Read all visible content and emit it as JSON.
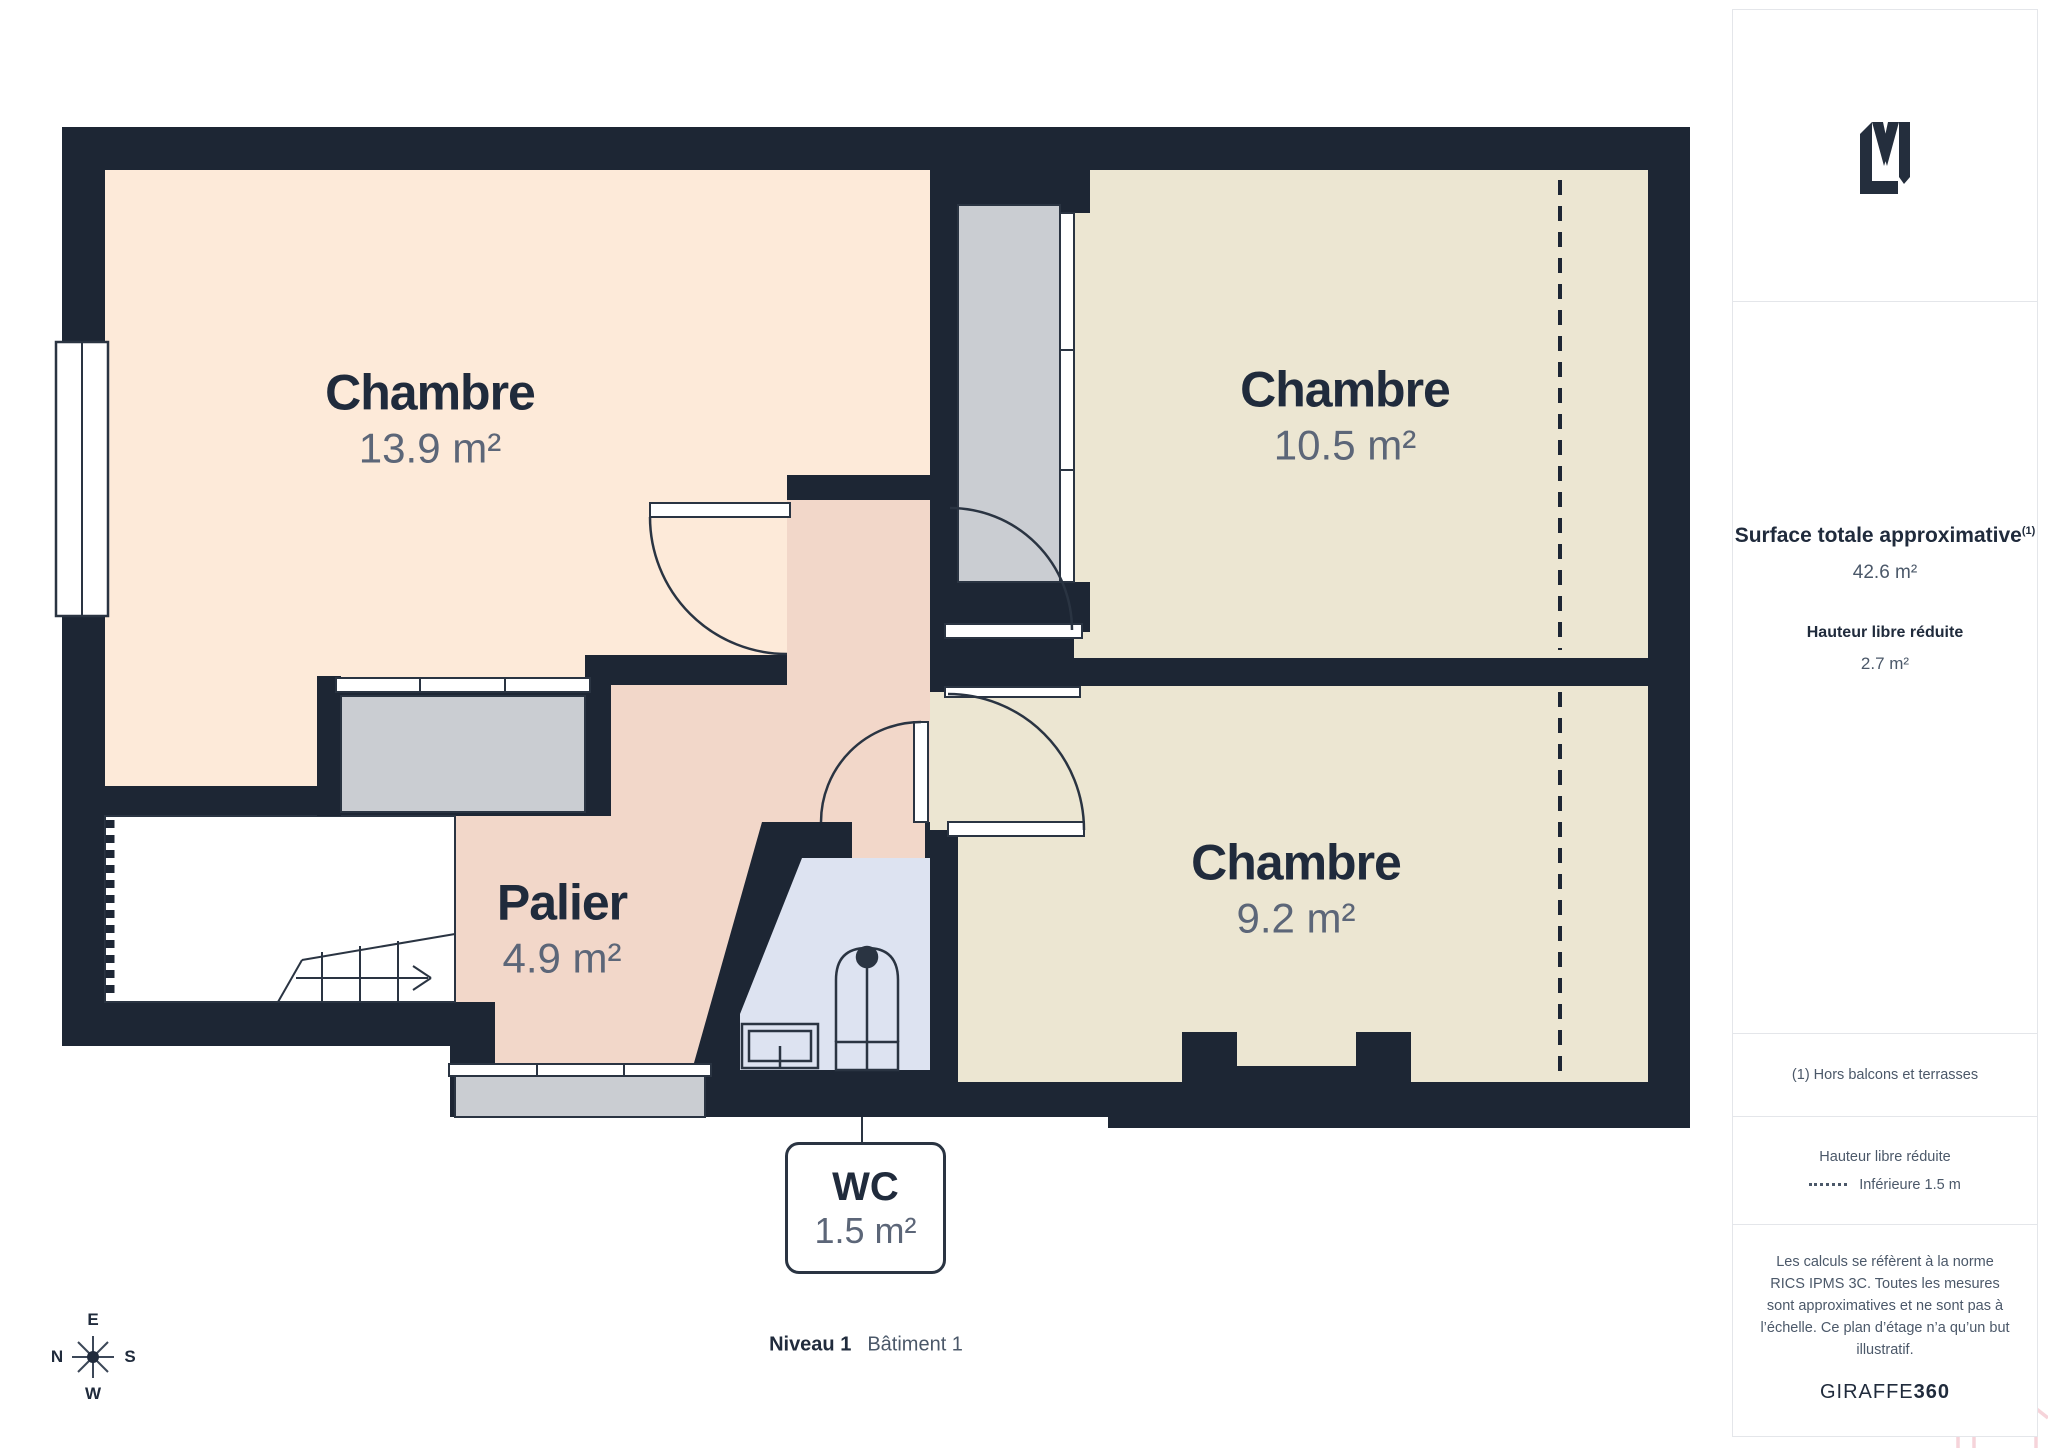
{
  "plan": {
    "rooms": [
      {
        "name": "Chambre",
        "area": "13.9 m²"
      },
      {
        "name": "Chambre",
        "area": "10.5 m²"
      },
      {
        "name": "Chambre",
        "area": "9.2 m²"
      },
      {
        "name": "Palier",
        "area": "4.9 m²"
      },
      {
        "name": "WC",
        "area": "1.5 m²"
      }
    ],
    "level_label": "Niveau 1",
    "building_label": "Bâtiment 1",
    "compass": {
      "top": "E",
      "left": "N",
      "right": "S",
      "bottom": "W"
    }
  },
  "sidebar": {
    "surface_title": "Surface totale approximative",
    "surface_sup": "(1)",
    "surface_value": "42.6 m²",
    "height_title": "Hauteur libre réduite",
    "height_value": "2.7 m²",
    "footnote": "(1) Hors balcons et terrasses",
    "legend_title": "Hauteur libre réduite",
    "legend_item": "Inférieure 1.5 m",
    "disclaimer": "Les calculs se réfèrent à la norme RICS IPMS 3C. Toutes les mesures sont approximatives et ne sont pas à l’échelle. Ce plan d’étage n’a qu’un but illustratif.",
    "brand": "GIRAFFE",
    "brand_bold": "360"
  },
  "colors": {
    "wall": "#1d2634",
    "peach": "#fdead9",
    "beige": "#ece6d2",
    "pink": "#f2d7c9",
    "blue": "#dde3f1",
    "winGray": "#cacdd2",
    "line": "#2a3442",
    "ink": "#202b3c",
    "muted": "#5c6678",
    "sideBorder": "#e4e6ea",
    "sideText": "#4b5869",
    "brandPink": "#f3c6ce"
  }
}
